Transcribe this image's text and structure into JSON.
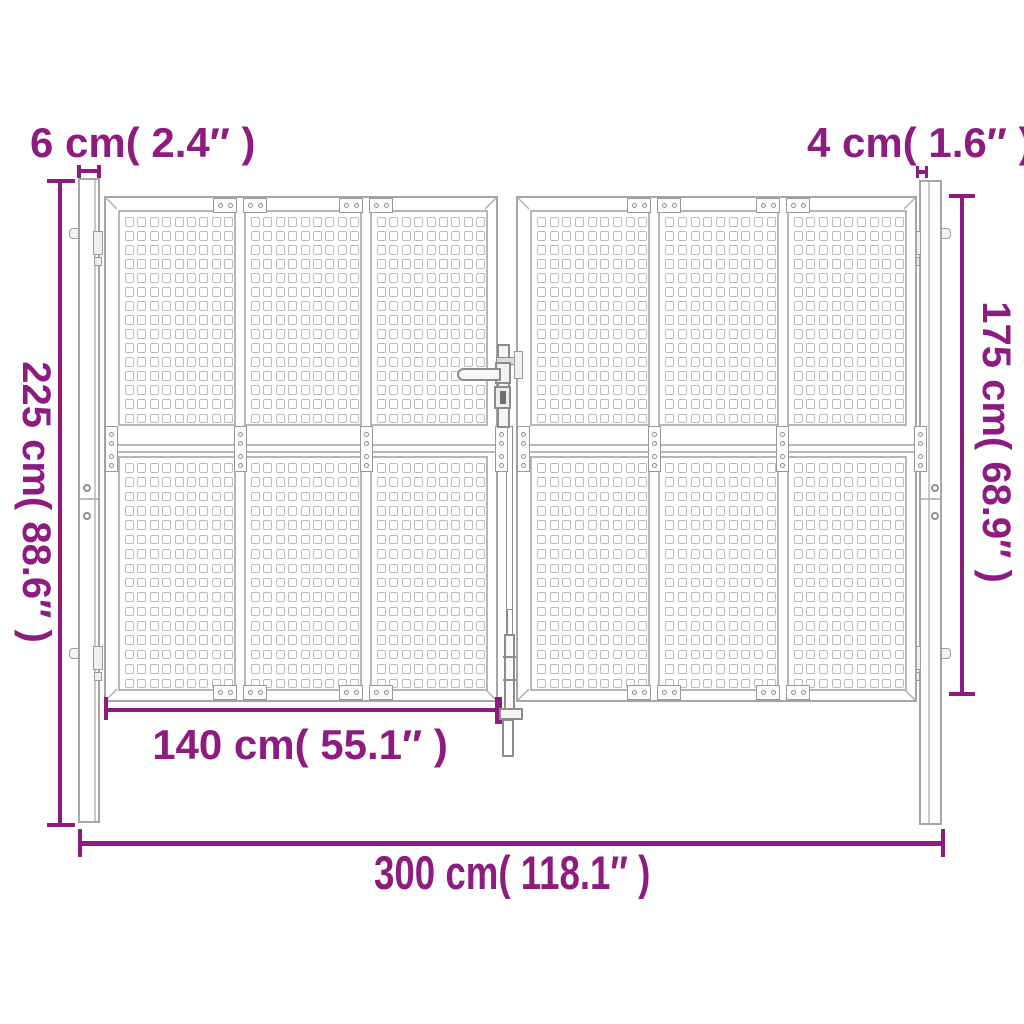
{
  "diagram": {
    "type": "product-dimension-diagram",
    "subject": "double garden gate with two posts, perforated square-hole panels, lever handle and drop rod",
    "accent_color": "#8E1C80",
    "outline_color": "#A6A6A6",
    "labels": {
      "post_left_width": "6 cm( 2.4″ )",
      "post_right_width": "4 cm( 1.6″ )",
      "post_height": "225 cm( 88.6″ )",
      "gate_height": "175 cm( 68.9″ )",
      "half_width": "140 cm( 55.1″ )",
      "total_width": "300 cm( 118.1″ )"
    },
    "measurements": {
      "post_left_width_cm": "6",
      "post_left_width_in": "2.4",
      "post_right_width_cm": "4",
      "post_right_width_in": "1.6",
      "post_height_cm": "225",
      "post_height_in": "88.6",
      "gate_height_cm": "175",
      "gate_height_in": "68.9",
      "half_width_cm": "140",
      "half_width_in": "55.1",
      "total_width_cm": "300",
      "total_width_in": "118.1"
    }
  }
}
